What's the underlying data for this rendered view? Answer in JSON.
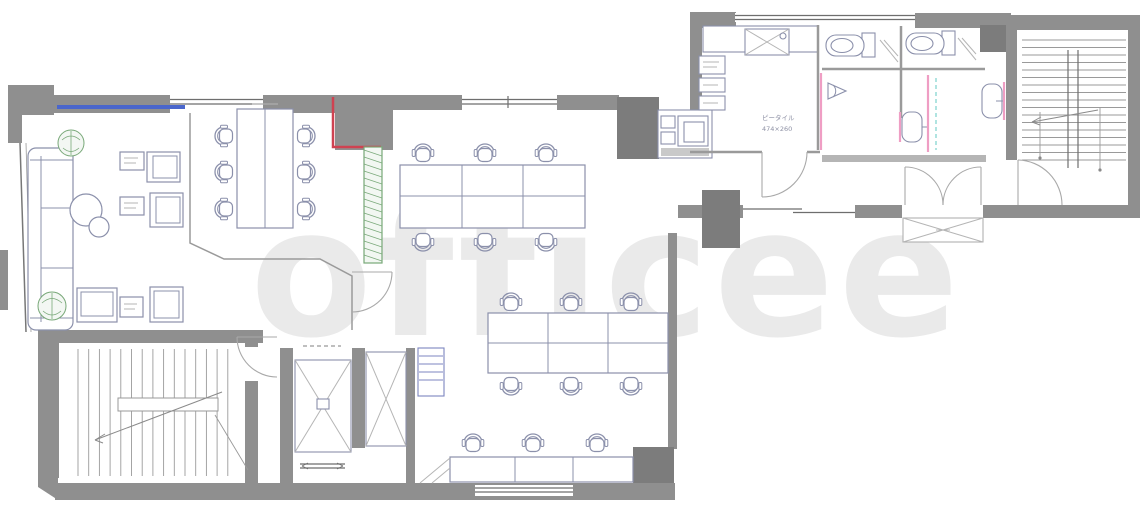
{
  "plan": {
    "title": "office-floor-plan",
    "watermark": "officee",
    "hall_note_line1": "ピータイル",
    "hall_note_line2": "474×260"
  },
  "colors": {
    "wall": "#8f8f8f",
    "wallDark": "#7c7c7c",
    "wallLine": "#9a9a9a",
    "furniture": "#8b90ab",
    "window_blue": "#4a66cc",
    "accent_red": "#cf4251",
    "accent_pink": "#ef9ec4",
    "accent_cyan": "#8fd9d4",
    "plant_green": "#78a878",
    "watermark_gray": "#eaeaea"
  },
  "counts": {
    "meeting_chairs": 6,
    "workstations_upper_island": 6,
    "workstations_lower_island": 6,
    "workstations_window_row": 3,
    "lounge_armchairs": 4,
    "toilets": 2,
    "washbasins": 2
  }
}
